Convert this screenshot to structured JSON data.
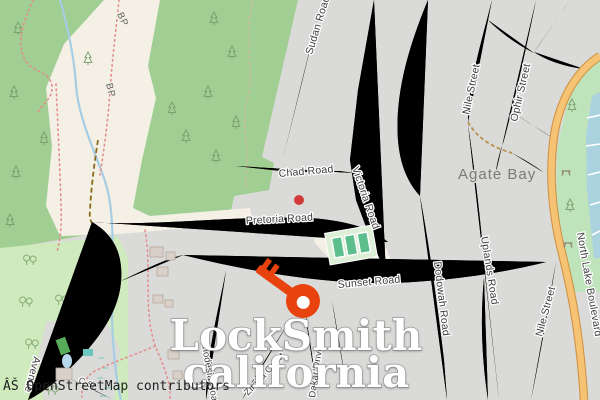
{
  "map": {
    "attribution": "ÂŠ OpenStreetMap contributors",
    "brand": {
      "line1": "LockSmith",
      "line2": "california"
    },
    "place_label": "Agate Bay",
    "piste_label": "BP",
    "labels": {
      "sudan": "Sudan Road",
      "chad": "Chad Road",
      "victoria": "Victoria Road",
      "pretoria": "Pretoria Road",
      "sunset": "Sunset Road",
      "nile": "Nile Street",
      "ophir": "Ophir Street",
      "dodowah": "Dodowah Road",
      "uplands": "Uplands Road",
      "north_lake": "North Lake Boulevard",
      "rhodesia": "Rhodesia Road",
      "zimba": "Zimba Court",
      "dakar": "Dakar Drive",
      "avenue": "Avenue",
      "c_st": "C St"
    },
    "marker": {
      "name": "key-marker",
      "color": "#e8420e"
    },
    "poi_dot_color": "#d33b3b",
    "colors": {
      "urban": "#dadad8",
      "woods": "#a1ce92",
      "park": "#cfeabc",
      "piste": "#f4f0e6",
      "water": "#aad3df",
      "road": "#ffffff",
      "road_casing": "#c9c9c6",
      "boulevard": "#f6c374",
      "boulevard_casing": "#cf9447",
      "tennis_court": "#5cbd8d",
      "building": "#d9d0c9",
      "trail_red": "#e38e8e",
      "track_brown": "#8a6b1c"
    }
  }
}
